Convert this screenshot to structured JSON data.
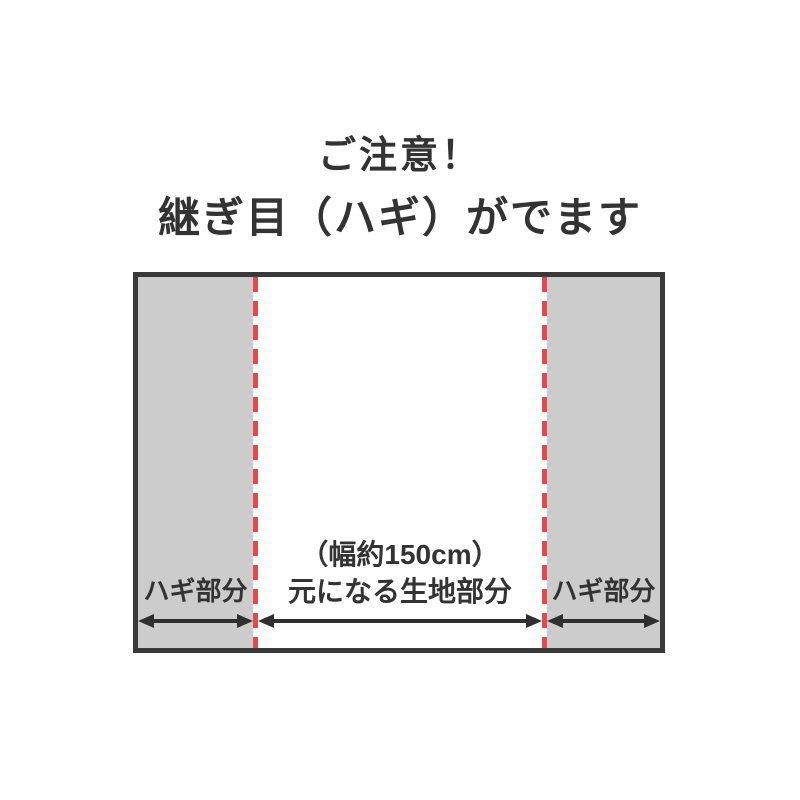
{
  "title": {
    "line1": "ご注意！",
    "line2": "継ぎ目（ハギ）がでます"
  },
  "diagram": {
    "left_section_label": "ハギ部分",
    "center_width_note": "（幅約150cm）",
    "center_section_label": "元になる生地部分",
    "right_section_label": "ハギ部分"
  },
  "colors": {
    "text": "#333333",
    "border": "#3a3a3a",
    "hagi_fill": "#cccccc",
    "seam_red": "#df4b51",
    "arrow": "#2f2f2f",
    "page_bg": "#ffffff"
  }
}
